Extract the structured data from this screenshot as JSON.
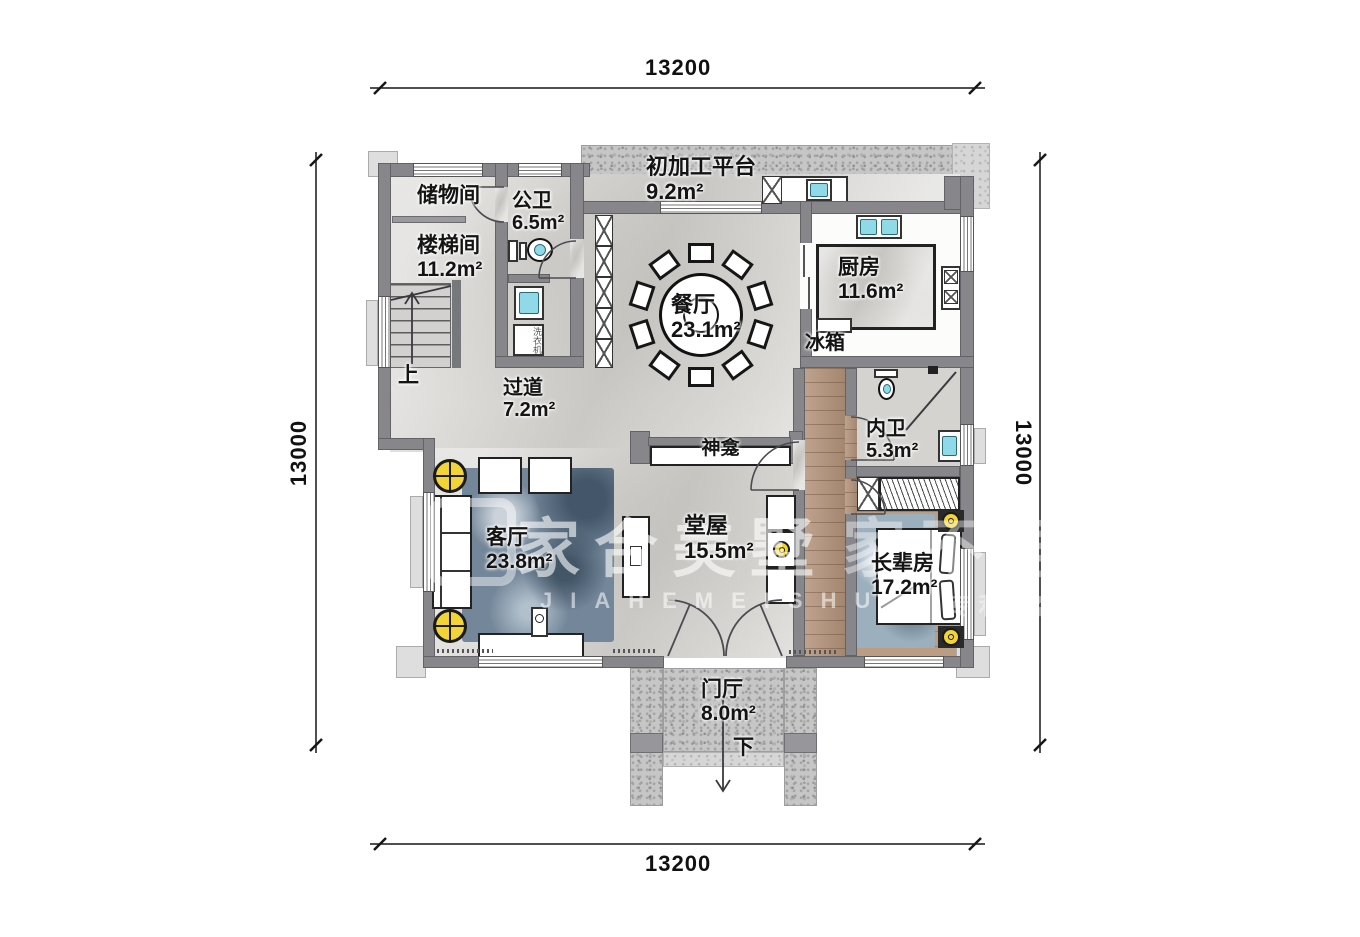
{
  "dimensions": {
    "top": "13200",
    "bottom": "13200",
    "left": "13000",
    "right": "13000"
  },
  "rooms": {
    "platform": {
      "name": "初加工平台",
      "area": "9.2m²"
    },
    "storage": {
      "name": "储物间"
    },
    "stairwell": {
      "name": "楼梯间",
      "area": "11.2m²"
    },
    "public_bath": {
      "name": "公卫",
      "area": "6.5m²"
    },
    "dining": {
      "name": "餐厅",
      "area": "23.1m²"
    },
    "kitchen": {
      "name": "厨房",
      "area": "11.6m²"
    },
    "corridor": {
      "name": "过道",
      "area": "7.2m²"
    },
    "inner_bath": {
      "name": "内卫",
      "area": "5.3m²"
    },
    "living": {
      "name": "客厅",
      "area": "23.8m²"
    },
    "hall": {
      "name": "堂屋",
      "area": "15.5m²"
    },
    "elder": {
      "name": "长辈房",
      "area": "17.2m²"
    },
    "foyer": {
      "name": "门厅",
      "area": "8.0m²"
    }
  },
  "fixtures": {
    "fridge": "冰箱",
    "shrine": "神龛",
    "washer": "洗衣机"
  },
  "nav": {
    "up": "上",
    "down": "下"
  },
  "watermark": {
    "cn": "家合美墅",
    "latin": "JIAHEMEISHU",
    "frag_cn": "家不再",
    "frag_small": "原 专利 盗"
  },
  "colors": {
    "wall": "#87878b",
    "accent_yellow": "#f2d437",
    "water_cyan": "#8fd9e8",
    "wood": "#b2927a"
  }
}
